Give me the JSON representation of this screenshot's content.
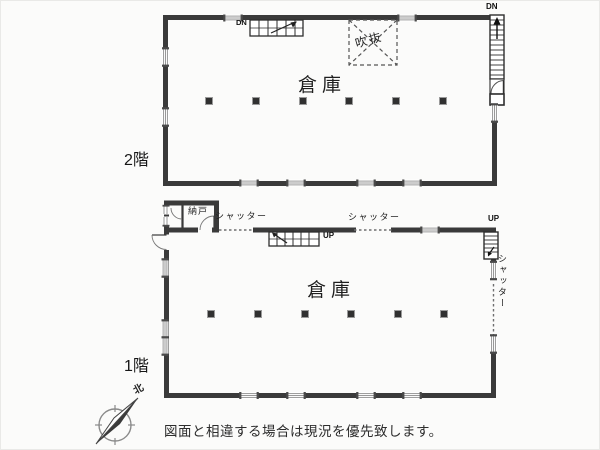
{
  "page": {
    "background_color": "#fbfbfa",
    "wall_color": "#3a3a3a",
    "disclaimer": "図面と相違する場合は現況を優先致します。"
  },
  "floor_2f": {
    "floor_label": "2階",
    "room_label": "倉庫",
    "void_label": "吹抜",
    "stairs_down_left_label": "DN",
    "stairs_down_right_label": "DN"
  },
  "floor_1f": {
    "floor_label": "1階",
    "room_label": "倉庫",
    "storeroom_label": "納戸",
    "shutter_left_label": "シャッター",
    "shutter_center_label": "シャッター",
    "shutter_right_label": "シャッター",
    "stairs_up_center_label": "UP",
    "stairs_up_right_label": "UP"
  },
  "compass": {
    "north_label": "北"
  }
}
